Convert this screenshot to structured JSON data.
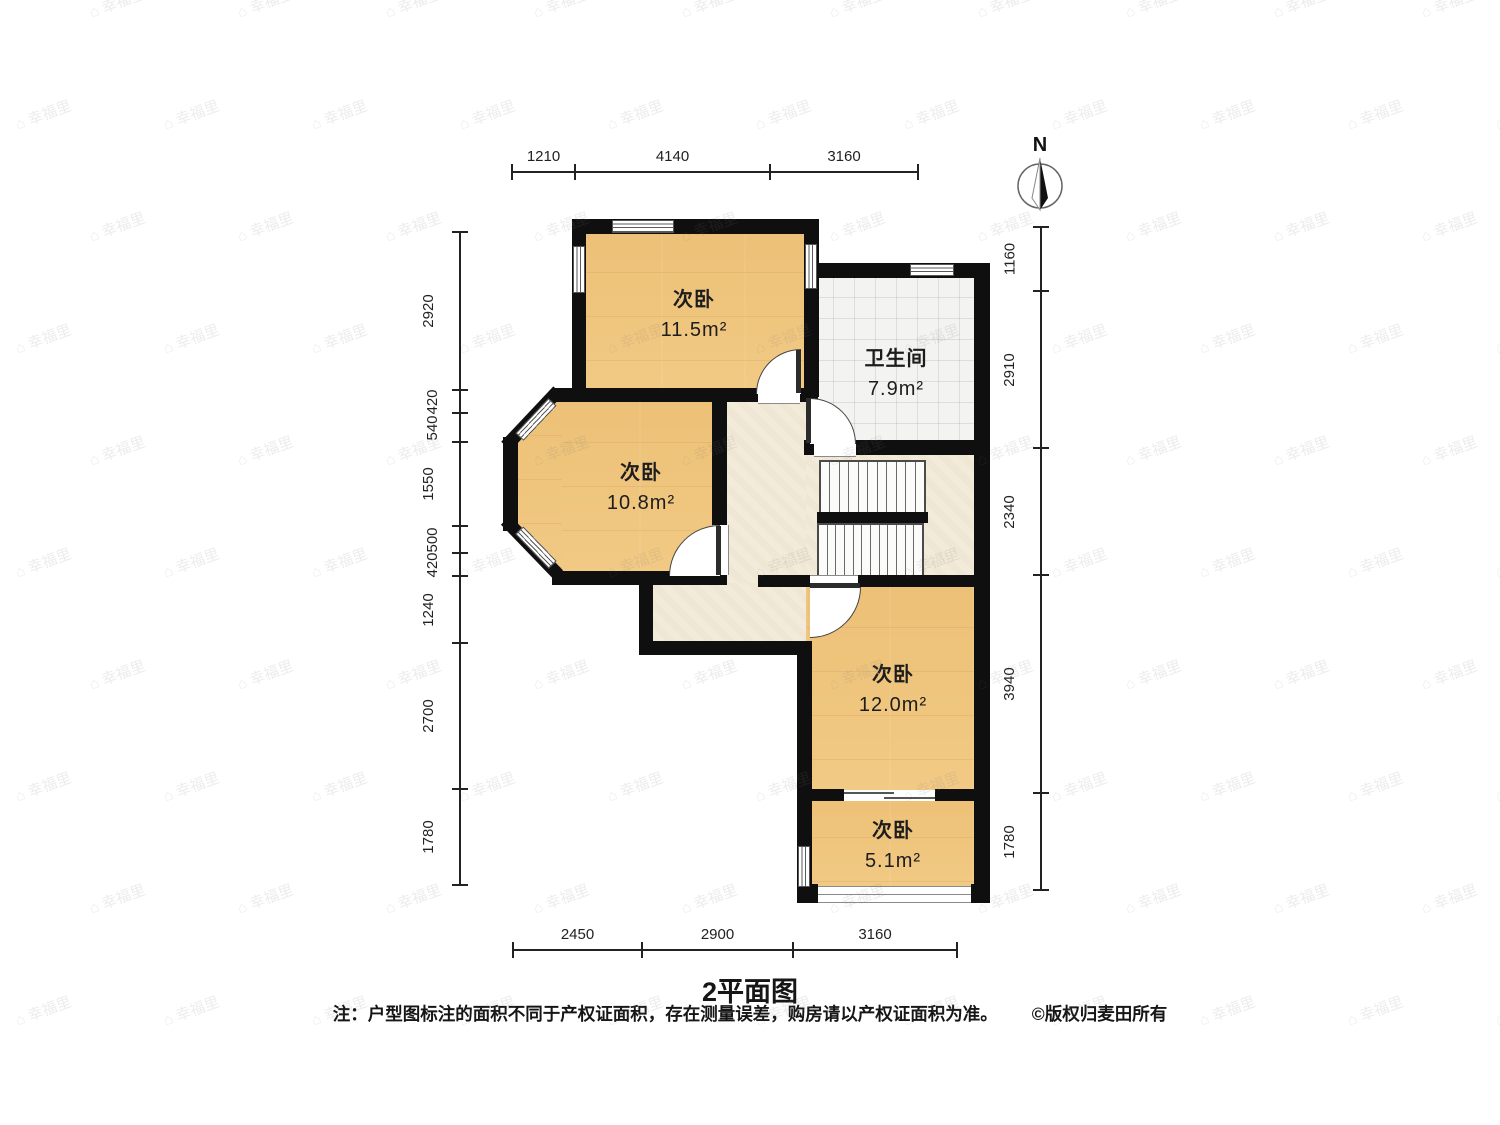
{
  "title": "2平面图",
  "note": "注：户型图标注的面积不同于产权证面积，存在测量误差，购房请以产权证面积为准。",
  "copyright": "©版权归麦田所有",
  "compass": {
    "label": "N"
  },
  "watermark": {
    "icon": "⌂",
    "text": "幸福里"
  },
  "colors": {
    "wall": "#0f0f0f",
    "wood_floor": "#f0c67e",
    "hall_floor": "#f3ebd9",
    "tile_floor": "#f3f3f1"
  },
  "rooms": [
    {
      "id": "bedroom-top",
      "name": "次卧",
      "area": "11.5m²"
    },
    {
      "id": "bedroom-middle",
      "name": "次卧",
      "area": "10.8m²"
    },
    {
      "id": "bathroom",
      "name": "卫生间",
      "area": "7.9m²"
    },
    {
      "id": "bedroom-right",
      "name": "次卧",
      "area": "12.0m²"
    },
    {
      "id": "bedroom-small",
      "name": "次卧",
      "area": "5.1m²"
    }
  ],
  "stairs": {
    "upper_treads": 11,
    "lower_treads": 12
  },
  "dims": [
    {
      "id": "top",
      "orient": "h",
      "y": 171,
      "ticks": [
        512,
        575,
        770,
        918
      ],
      "segments": [
        {
          "label": "1210",
          "a": 512,
          "b": 575
        },
        {
          "label": "4140",
          "a": 575,
          "b": 770
        },
        {
          "label": "3160",
          "a": 770,
          "b": 918
        }
      ]
    },
    {
      "id": "bottom",
      "orient": "h",
      "y": 949,
      "ticks": [
        513,
        642,
        793,
        957
      ],
      "segments": [
        {
          "label": "2450",
          "a": 513,
          "b": 642
        },
        {
          "label": "2900",
          "a": 642,
          "b": 793
        },
        {
          "label": "3160",
          "a": 793,
          "b": 957
        }
      ]
    },
    {
      "id": "left",
      "orient": "v",
      "x": 459,
      "ticks": [
        232,
        390,
        413,
        442,
        526,
        553,
        576,
        643,
        789,
        885
      ],
      "segments": [
        {
          "label": "2920",
          "a": 232,
          "b": 390
        },
        {
          "label": "420",
          "a": 390,
          "b": 413
        },
        {
          "label": "540",
          "a": 413,
          "b": 442
        },
        {
          "label": "1550",
          "a": 442,
          "b": 526
        },
        {
          "label": "500",
          "a": 526,
          "b": 553
        },
        {
          "label": "420",
          "a": 553,
          "b": 576
        },
        {
          "label": "1240",
          "a": 576,
          "b": 643
        },
        {
          "label": "2700",
          "a": 643,
          "b": 789
        },
        {
          "label": "1780",
          "a": 789,
          "b": 885
        }
      ]
    },
    {
      "id": "right",
      "orient": "v",
      "x": 1040,
      "ticks": [
        227,
        291,
        448,
        575,
        793,
        890
      ],
      "segments": [
        {
          "label": "1160",
          "a": 227,
          "b": 291
        },
        {
          "label": "2910",
          "a": 291,
          "b": 448
        },
        {
          "label": "2340",
          "a": 448,
          "b": 575
        },
        {
          "label": "3940",
          "a": 575,
          "b": 793
        },
        {
          "label": "1780",
          "a": 793,
          "b": 890
        }
      ]
    }
  ]
}
